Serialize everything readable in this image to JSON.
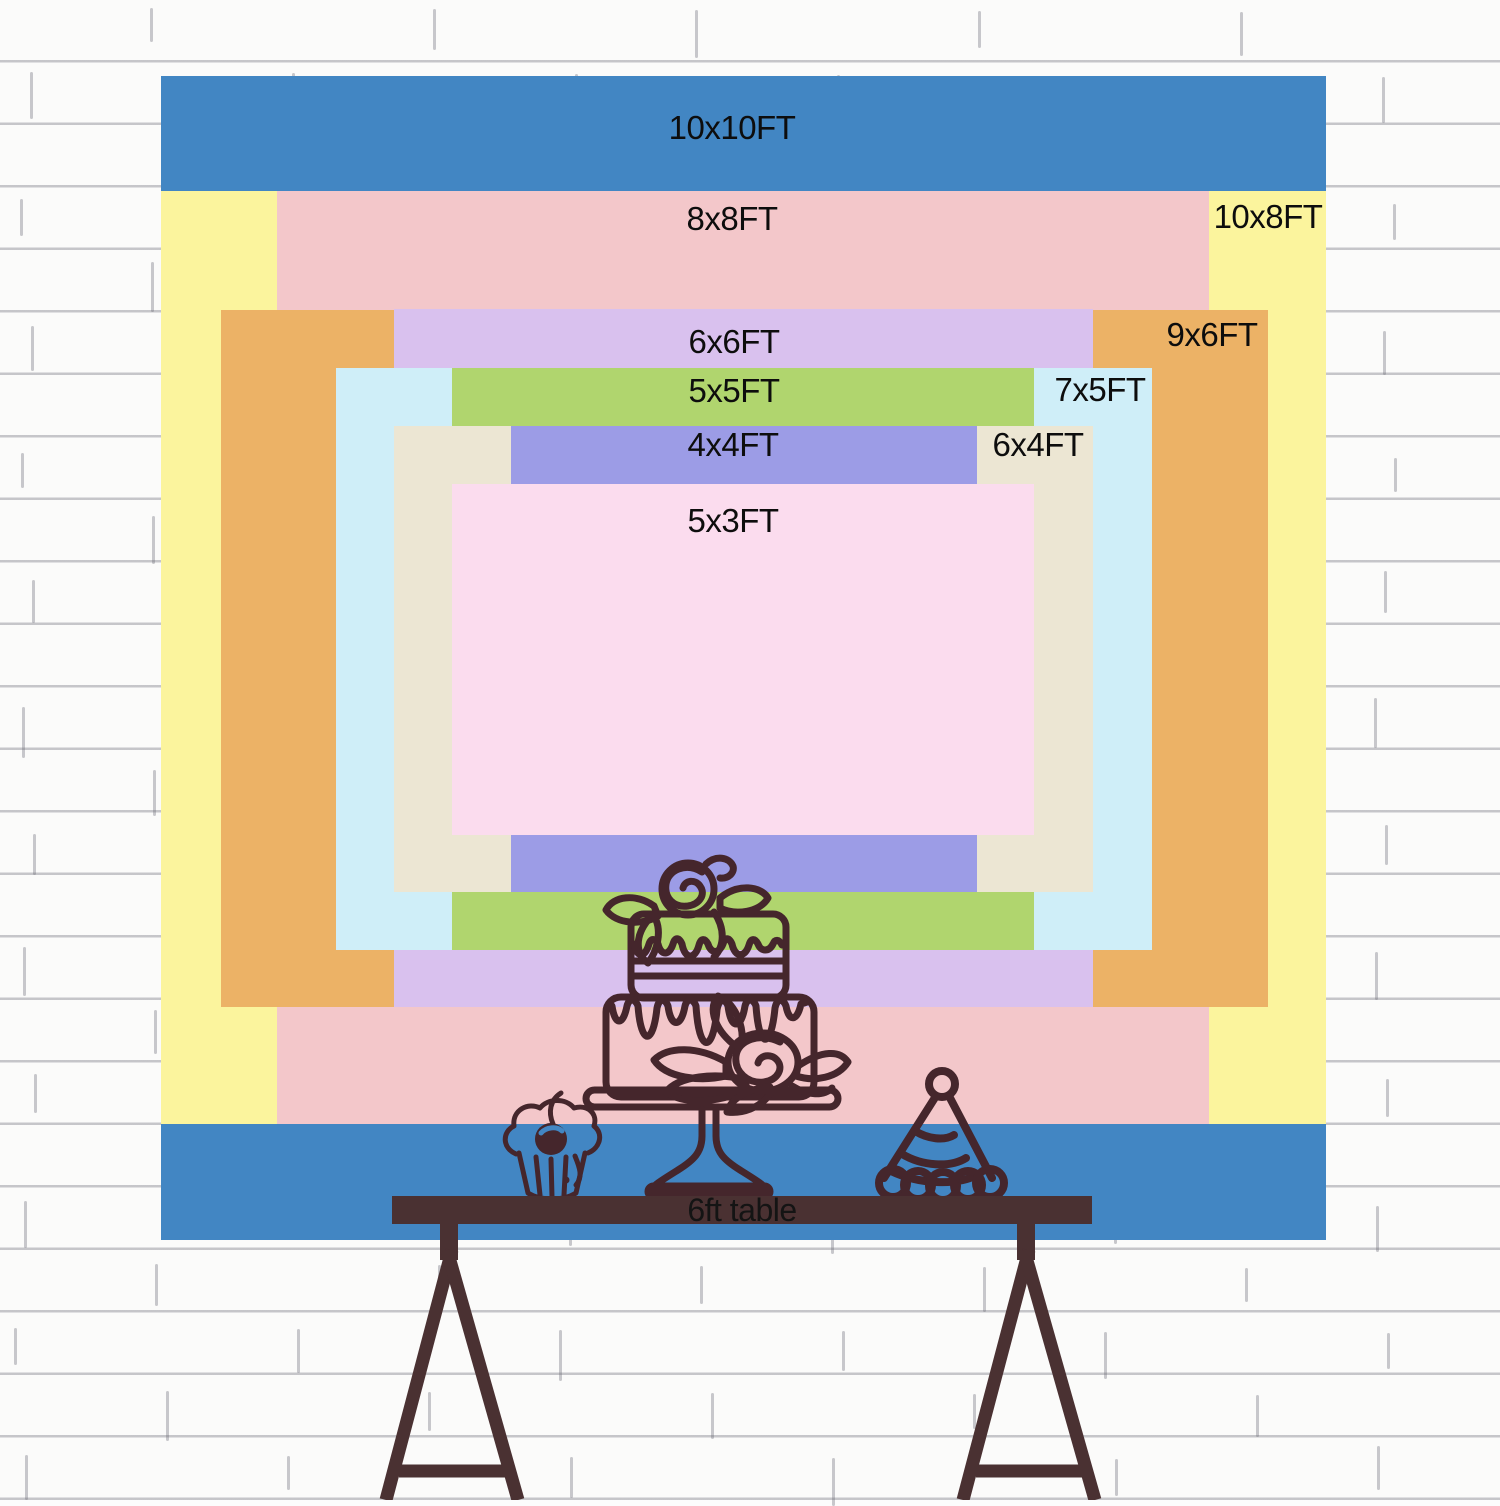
{
  "size_chart": {
    "unit": "FT",
    "label_color": "#0d0d0d",
    "sizes": [
      {
        "id": "10x10",
        "label": "10x10FT",
        "color": "#4286c3",
        "rect": {
          "x": 161,
          "y": 76,
          "w": 1165,
          "h": 1164
        },
        "label_pos": {
          "cx": 732,
          "cy": 128
        }
      },
      {
        "id": "10x8",
        "label": "10x8FT",
        "color": "#fbf49d",
        "rect": {
          "x": 161,
          "y": 191,
          "w": 1165,
          "h": 933
        },
        "label_pos": {
          "cx": 1268,
          "cy": 217
        }
      },
      {
        "id": "8x8",
        "label": "8x8FT",
        "color": "#f3c7ca",
        "rect": {
          "x": 277,
          "y": 191,
          "w": 932,
          "h": 933
        },
        "label_pos": {
          "cx": 732,
          "cy": 219
        }
      },
      {
        "id": "9x6",
        "label": "9x6FT",
        "color": "#ecb266",
        "rect": {
          "x": 221,
          "y": 310,
          "w": 1047,
          "h": 697
        },
        "label_pos": {
          "cx": 1212,
          "cy": 335
        }
      },
      {
        "id": "6x6",
        "label": "6x6FT",
        "color": "#d9c1ee",
        "rect": {
          "x": 394,
          "y": 309,
          "w": 699,
          "h": 698
        },
        "label_pos": {
          "cx": 734,
          "cy": 342
        }
      },
      {
        "id": "7x5",
        "label": "7x5FT",
        "color": "#cfeef8",
        "rect": {
          "x": 336,
          "y": 368,
          "w": 816,
          "h": 582
        },
        "label_pos": {
          "cx": 1100,
          "cy": 390
        }
      },
      {
        "id": "5x5",
        "label": "5x5FT",
        "color": "#b0d56e",
        "rect": {
          "x": 452,
          "y": 368,
          "w": 582,
          "h": 582
        },
        "label_pos": {
          "cx": 734,
          "cy": 391
        }
      },
      {
        "id": "6x4",
        "label": "6x4FT",
        "color": "#ece6d3",
        "rect": {
          "x": 394,
          "y": 426,
          "w": 699,
          "h": 466
        },
        "label_pos": {
          "cx": 1038,
          "cy": 445
        }
      },
      {
        "id": "4x4",
        "label": "4x4FT",
        "color": "#9c9ce6",
        "rect": {
          "x": 511,
          "y": 426,
          "w": 466,
          "h": 466
        },
        "label_pos": {
          "cx": 733,
          "cy": 445
        }
      },
      {
        "id": "5x3",
        "label": "5x3FT",
        "color": "#fbdcee",
        "rect": {
          "x": 452,
          "y": 484,
          "w": 582,
          "h": 351
        },
        "label_pos": {
          "cx": 733,
          "cy": 521
        }
      }
    ]
  },
  "table": {
    "label": "6ft table",
    "bar_color": "#4a3132",
    "label_color": "#141414",
    "bar": {
      "x": 392,
      "y": 1196,
      "w": 700,
      "h": 28
    }
  },
  "illustration": {
    "stroke_color": "#45262c",
    "icons": [
      "cake-icon",
      "cupcake-icon",
      "party-hat-icon"
    ]
  },
  "wall": {
    "base_color": "#fbfbfa",
    "line_color": "#6e6e7a"
  }
}
